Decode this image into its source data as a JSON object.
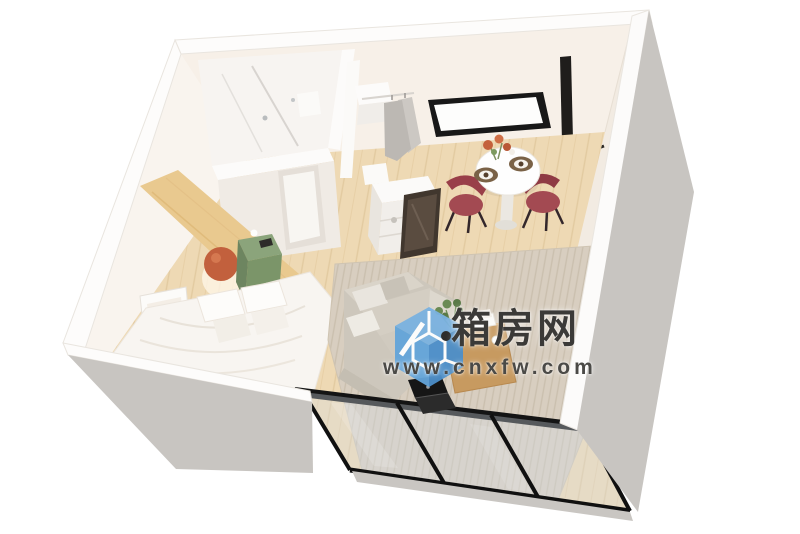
{
  "page": {
    "type": "3d-interior-render",
    "description": "Isometric 3D cutaway render of a compact studio room with bathroom, open wardrobe, dining set, double bed, sofa, rug and black-framed glass sliding doors; white and gray exterior walls on a white background",
    "background": "#ffffff"
  },
  "watermark": {
    "site_name": "箱房网",
    "url": "www.cnxfw.com",
    "logo_icon": "blue-cube-logo",
    "logo_color": "#5f9fd6",
    "site_name_color": "#3b3a38",
    "url_color": "#4b4a47"
  },
  "scene": {
    "elements": [
      "bathroom with glass shower partition",
      "open wardrobe with hanging gray clothes",
      "white dresser with dark leaning mirror",
      "round white dining table with two maroon chairs",
      "black framed window on back wall",
      "double bed with white bedding and pillows",
      "sage-green nightstand",
      "terracotta wall lamp",
      "framed abstract terracotta art",
      "wood accent headboard panel",
      "gray fabric sofa with cushions",
      "wooden coffee table with plant, books and cup",
      "black laptop",
      "ribbed beige area rug",
      "light wood plank floor",
      "black framed glass sliding doors",
      "gray exterior side walls"
    ]
  }
}
